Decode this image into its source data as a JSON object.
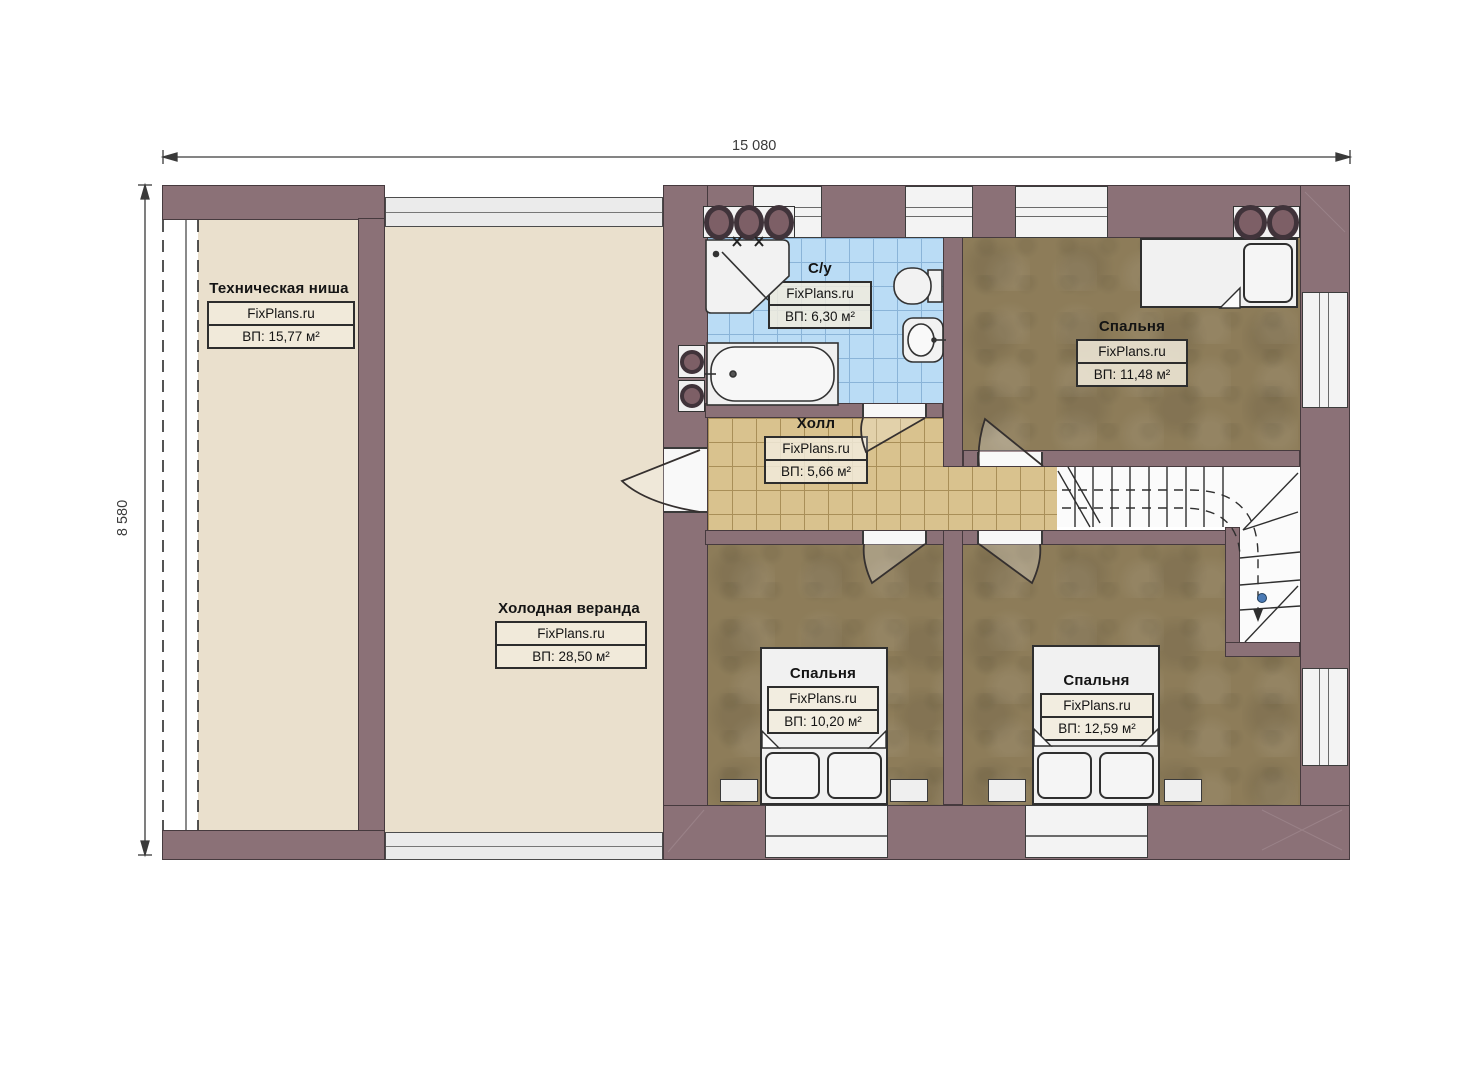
{
  "plan": {
    "dimensions": {
      "width": "15 080",
      "height": "8 580"
    },
    "rooms": {
      "tech_niche": {
        "title": "Техническая ниша",
        "brand": "FixPlans.ru",
        "area": "ВП: 15,77 м²"
      },
      "veranda": {
        "title": "Холодная веранда",
        "brand": "FixPlans.ru",
        "area": "ВП: 28,50 м²"
      },
      "bathroom": {
        "title": "С/у",
        "brand": "FixPlans.ru",
        "area": "ВП: 6,30 м²"
      },
      "hall": {
        "title": "Холл",
        "brand": "FixPlans.ru",
        "area": "ВП: 5,66 м²"
      },
      "bedroom_top_right": {
        "title": "Спальня",
        "brand": "FixPlans.ru",
        "area": "ВП: 11,48 м²"
      },
      "bedroom_bottom_left": {
        "title": "Спальня",
        "brand": "FixPlans.ru",
        "area": "ВП: 10,20 м²"
      },
      "bedroom_bottom_right": {
        "title": "Спальня",
        "brand": "FixPlans.ru",
        "area": "ВП: 12,59 м²"
      }
    },
    "colors": {
      "wall": "#8b7177",
      "outline": "#463a3e",
      "veranda": "#eae0cd",
      "bedroom": "#8d7c59",
      "bathtile": "#badcf5",
      "bathgrid": "#8ab4d8",
      "halltile": "#d9c28e",
      "hallgrid": "#a98f58",
      "fixture": "#f1f1f1",
      "dot": "#4a7ab5"
    }
  }
}
